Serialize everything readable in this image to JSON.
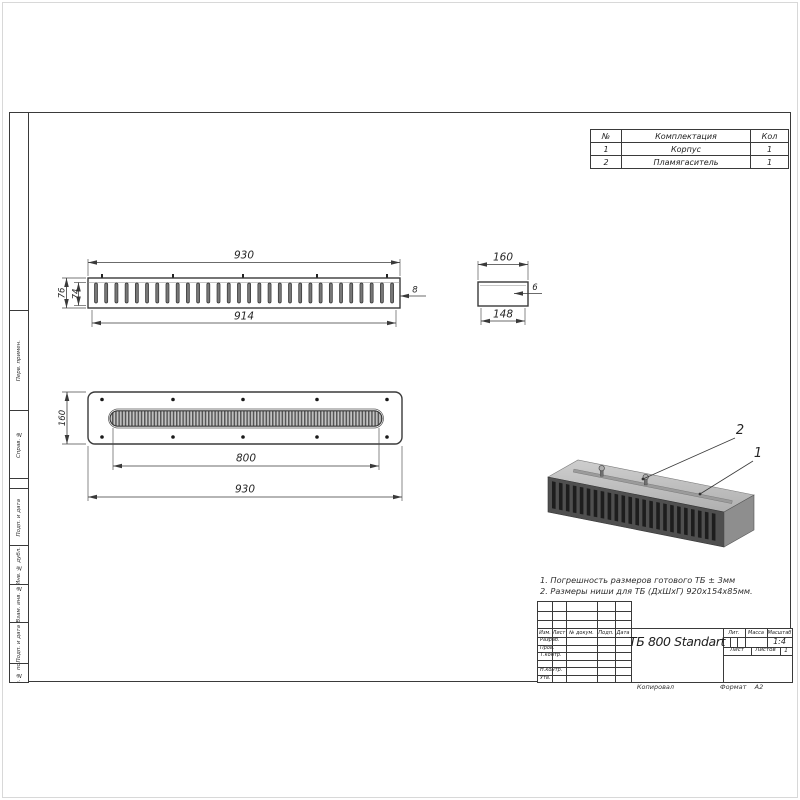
{
  "parts_table": {
    "col_no": "№",
    "col_name": "Комплектация",
    "col_qty": "Кол",
    "rows": [
      {
        "no": "1",
        "name": "Корпус",
        "qty": "1"
      },
      {
        "no": "2",
        "name": "Пламягаситель",
        "qty": "1"
      }
    ]
  },
  "front_view": {
    "dim_length_outer": "930",
    "dim_length_inner": "914",
    "dim_height_outer": "76",
    "dim_height_inner": "74",
    "dim_wall": "8",
    "slot_count": 30,
    "hole_columns": [
      102,
      173,
      243,
      317,
      387
    ]
  },
  "end_view": {
    "dim_width_outer": "160",
    "dim_width_inner": "148",
    "dim_wall": "6"
  },
  "plan_view": {
    "dim_width": "160",
    "dim_slot": "800",
    "dim_length": "930",
    "hole_columns": [
      102,
      173,
      243,
      317,
      387
    ]
  },
  "iso_view": {
    "callout_body": "1",
    "callout_flame_arrester": "2",
    "slot_count": 24
  },
  "notes": [
    "1. Погрешность размеров готового ТБ ± 3мм",
    "2. Размеры ниши для ТБ (ДхШхГ) 920х154х85мм."
  ],
  "title_block": {
    "doc_title": "ТБ 800 Standart",
    "col_izm": "Изм.",
    "col_list": "Лист",
    "col_ndok": "№ докум.",
    "col_podp": "Подп.",
    "col_data": "Дата",
    "row_razrab": "Разраб.",
    "row_prov": "Пров.",
    "row_tkontr": "Т.контр.",
    "row_nkontr": "Н.контр.",
    "row_utv": "Утв.",
    "lit_label": "Лит.",
    "mass_label": "Масса",
    "scale_label": "Масштаб",
    "scale_value": "1:4",
    "sheet_label": "Лист",
    "sheets_label": "Листов",
    "sheets_value": "1",
    "kopiroval": "Копировал",
    "format_label": "Формат",
    "format_value": "А2"
  },
  "side_stamps": [
    "Перв. примен.",
    "Справ. №",
    "Подп. и дата",
    "Инв. № дубл.",
    "Взам. инв. №",
    "Подп. и дата",
    "Инв. № подл."
  ],
  "colors": {
    "line": "#3a3a3a",
    "iso_front": "#4f4f4f",
    "iso_top": "#c2c2c2",
    "iso_side": "#8e8e8e"
  }
}
